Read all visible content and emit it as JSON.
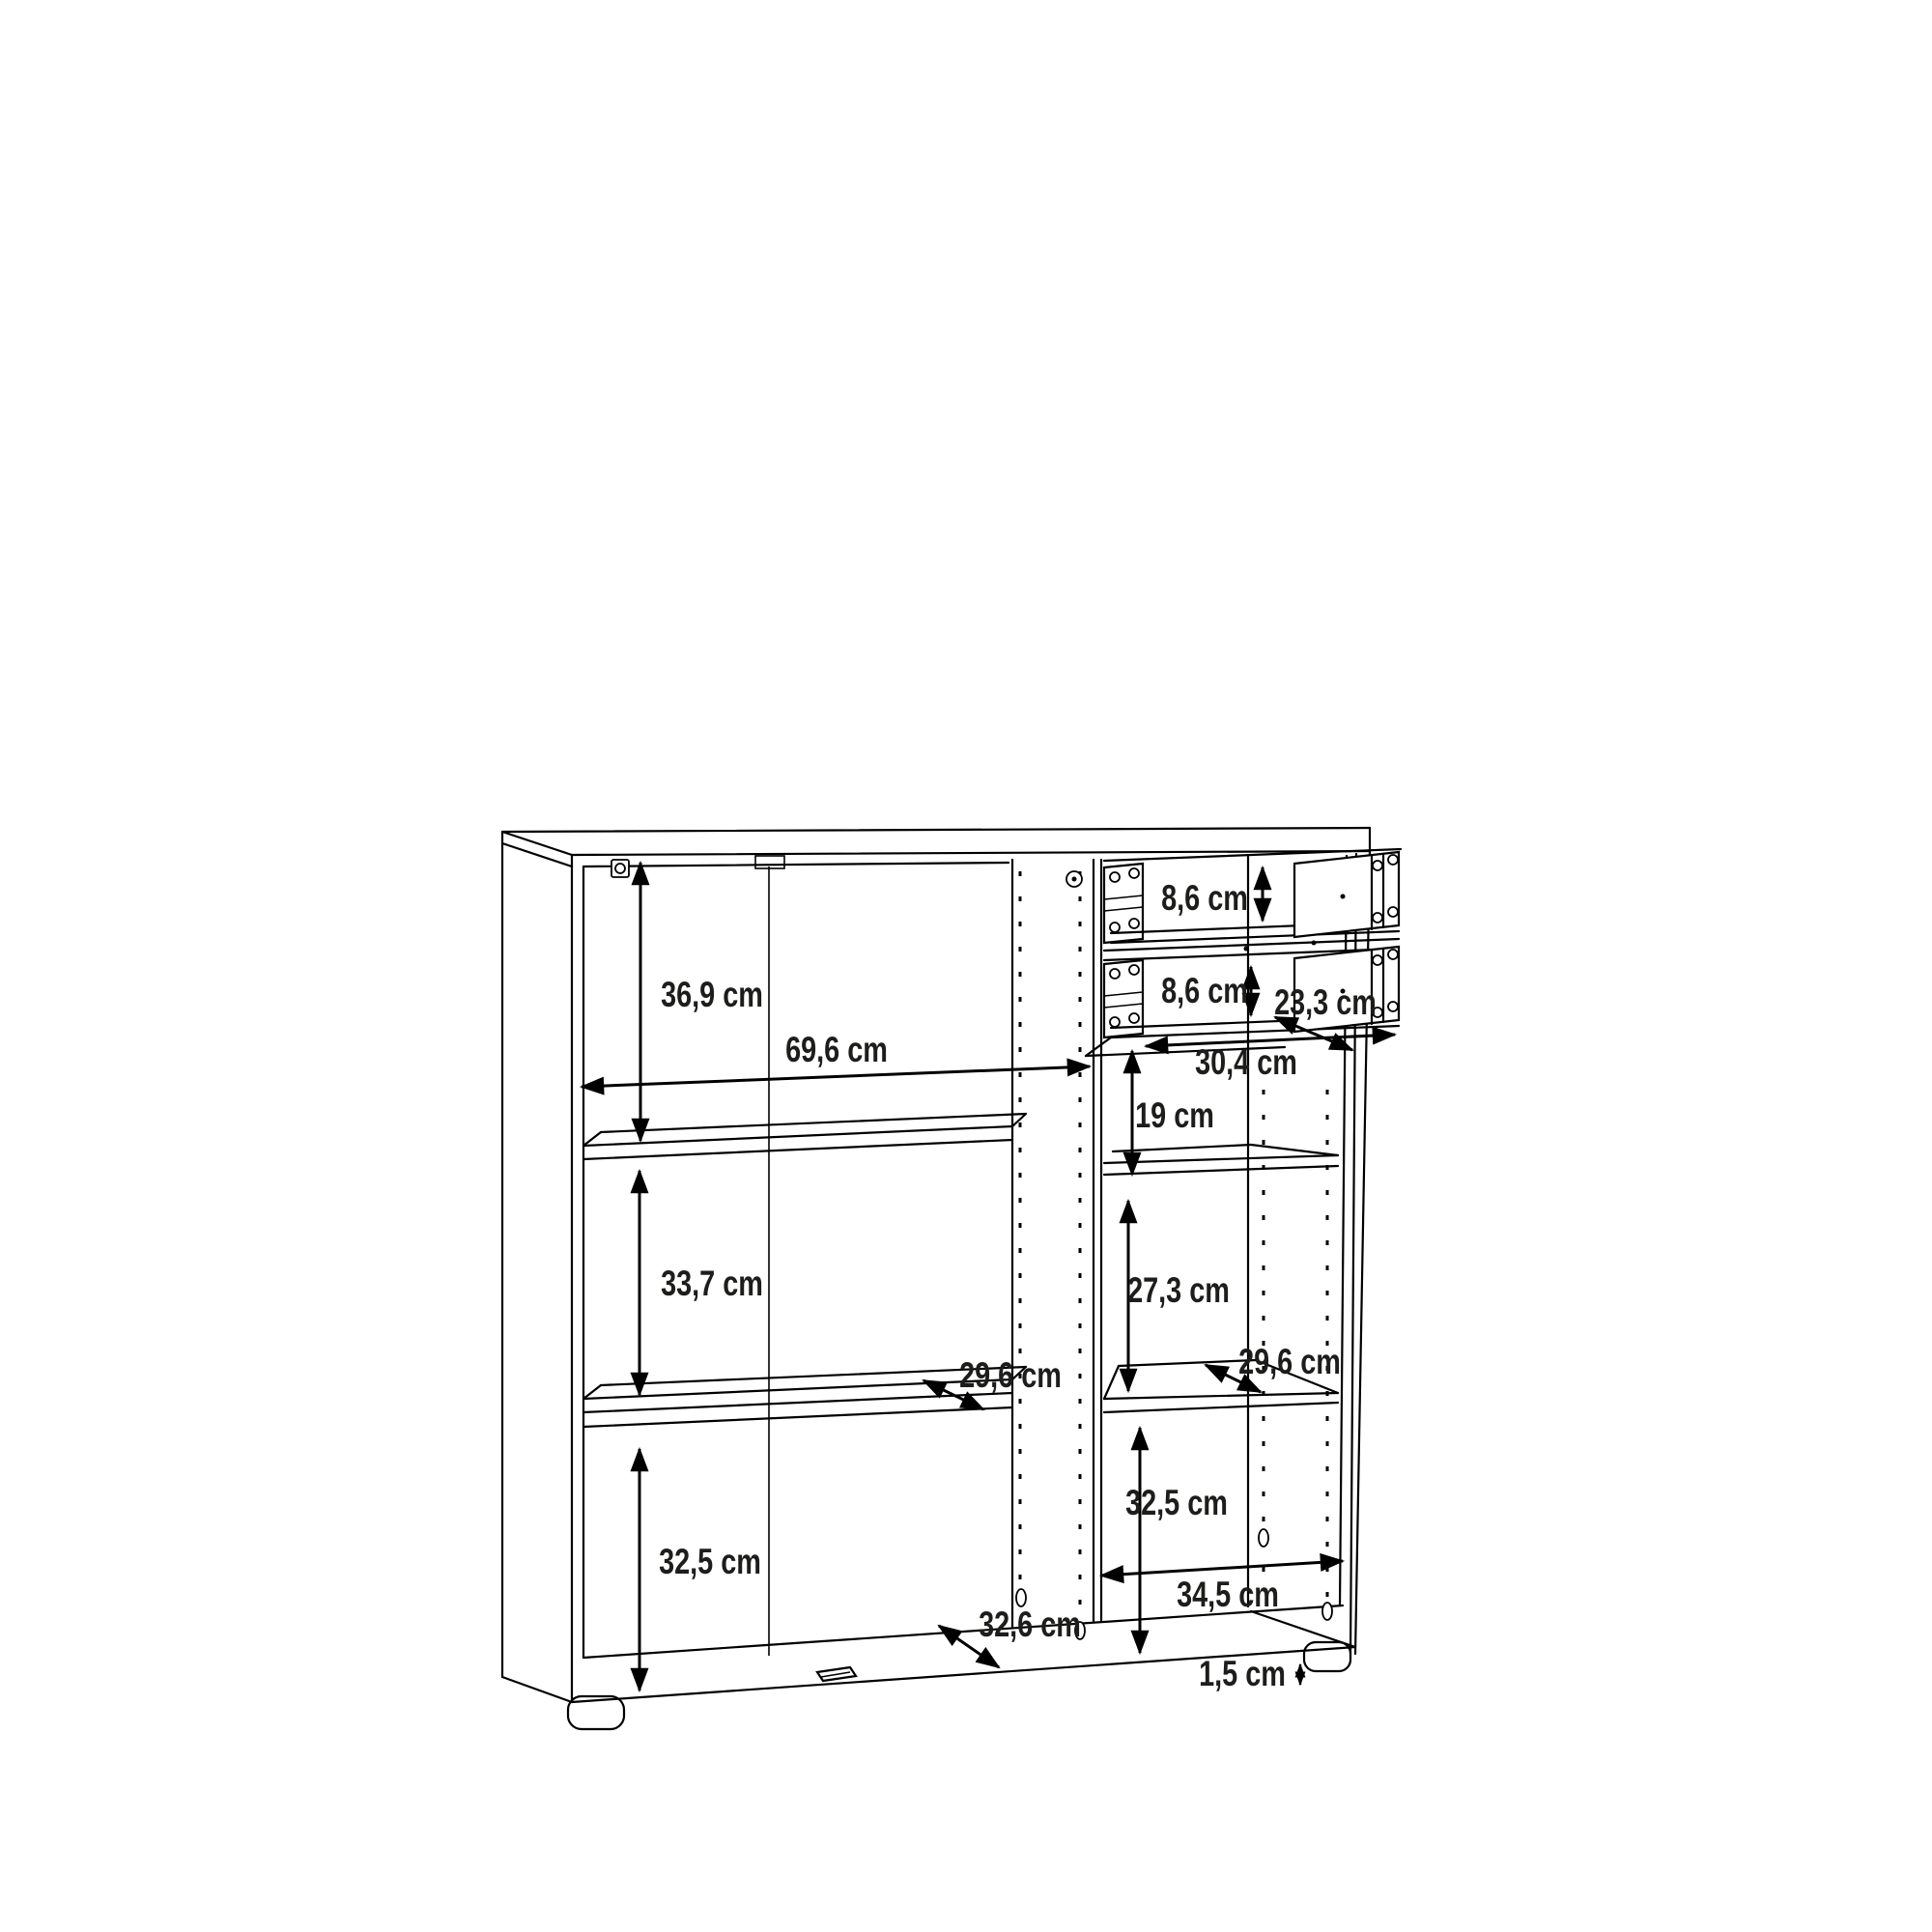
{
  "diagram": {
    "kind": "furniture-dimension-drawing",
    "subject": "open sideboard cabinet with shelves and two drawers",
    "unit": "cm",
    "colors": {
      "line": "#000000",
      "label": "#1d1d1b",
      "background": "#ffffff"
    }
  },
  "labels": {
    "left_top_height": "36,9 cm",
    "left_width": "69,6 cm",
    "left_middle_height": "33,7 cm",
    "left_bottom_height": "32,5 cm",
    "left_shelf_depth": "29,6 cm",
    "left_bottom_depth": "32,6 cm",
    "drawer1_height": "8,6 cm",
    "drawer2_height": "8,6 cm",
    "drawer_depth": "23,3 cm",
    "drawer_width": "30,4 cm",
    "right_top_height": "19 cm",
    "right_middle_height": "27,3 cm",
    "right_shelf_depth": "29,6 cm",
    "right_bottom_height": "32,5 cm",
    "right_width": "34,5 cm",
    "foot_height": "1,5 cm"
  }
}
